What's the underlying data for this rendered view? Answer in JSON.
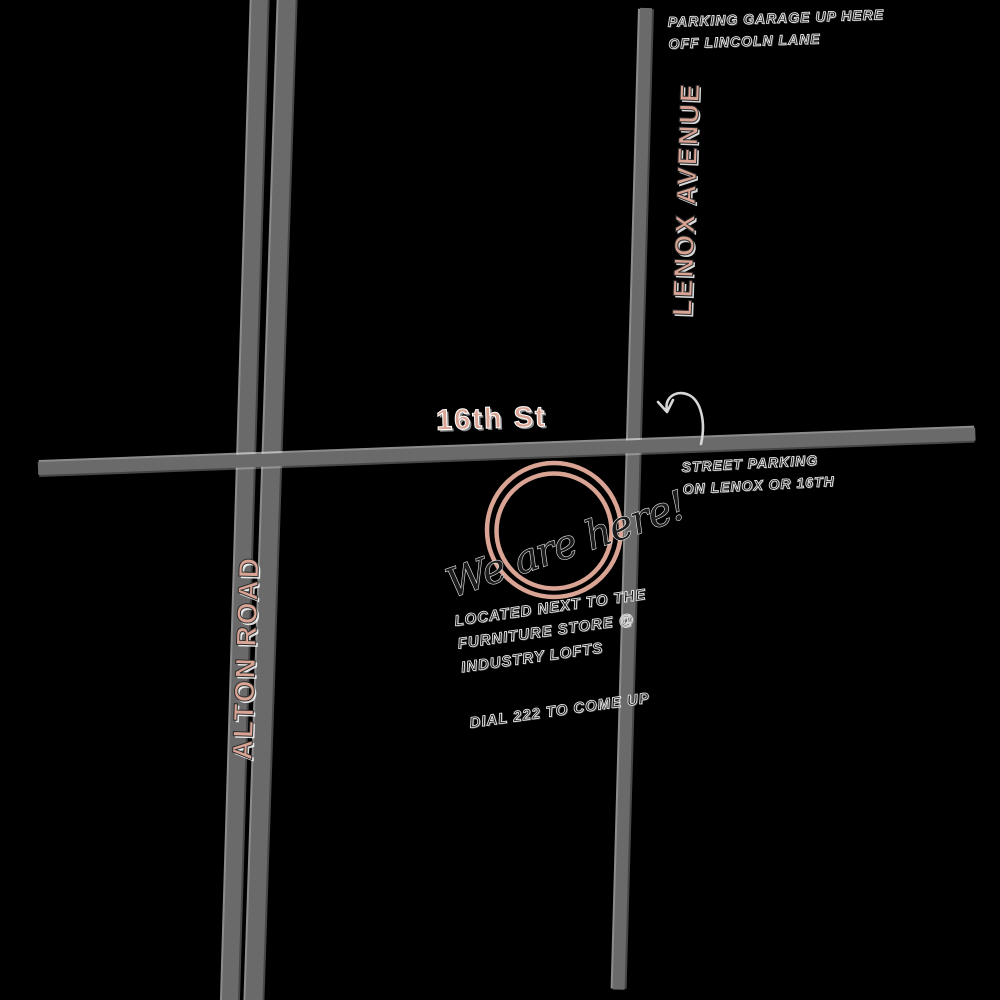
{
  "colors": {
    "bg": "#000000",
    "road": "#6a6a6a",
    "accent": "#d9a494",
    "ink": "#1c1c1c"
  },
  "roads": {
    "alton": {
      "label": "ALTON ROAD"
    },
    "lenox": {
      "label": "LENOX AVENUE"
    },
    "sixteenth": {
      "label": "16th St"
    }
  },
  "marker": {
    "label": "We are here!"
  },
  "notes": {
    "parking_garage": {
      "lines": [
        "PARKING GARAGE UP HERE",
        "OFF LINCOLN LANE"
      ]
    },
    "street_parking": {
      "lines": [
        "STREET PARKING",
        "ON LENOX OR 16TH"
      ]
    },
    "located": {
      "lines": [
        "LOCATED NEXT TO THE",
        "FURNITURE STORE @",
        "INDUSTRY LOFTS"
      ]
    },
    "dial": {
      "lines": [
        "DIAL 222 TO COME UP"
      ]
    }
  }
}
